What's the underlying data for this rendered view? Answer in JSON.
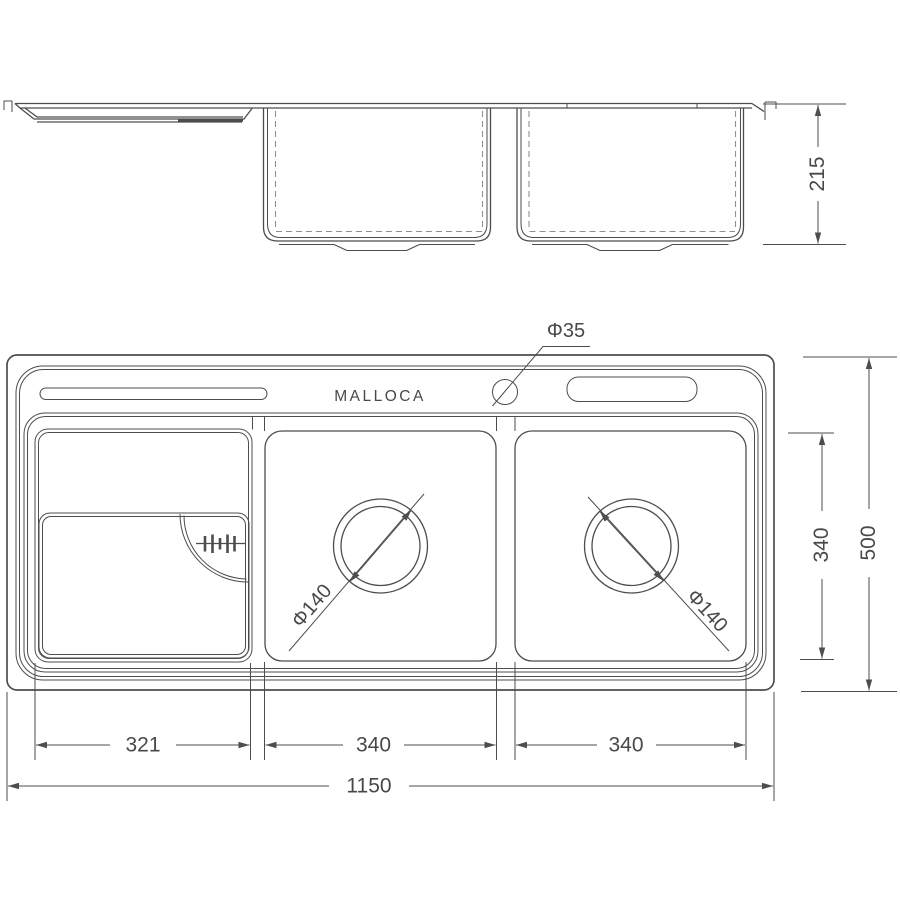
{
  "brand": "MALLOCA",
  "labels": {
    "depth": "215",
    "left_compartment_width": "321",
    "middle_bowl_width": "340",
    "right_bowl_width": "340",
    "overall_length": "1150",
    "bowl_front_to_back": "340",
    "overall_width": "500",
    "faucet_hole_diameter": "Φ35",
    "middle_drain_diameter": "Φ140",
    "right_drain_diameter": "Φ140"
  },
  "colors": {
    "line": "#4d4d4d",
    "dash": "#909090",
    "text": "#484848",
    "bg": "#ffffff"
  }
}
